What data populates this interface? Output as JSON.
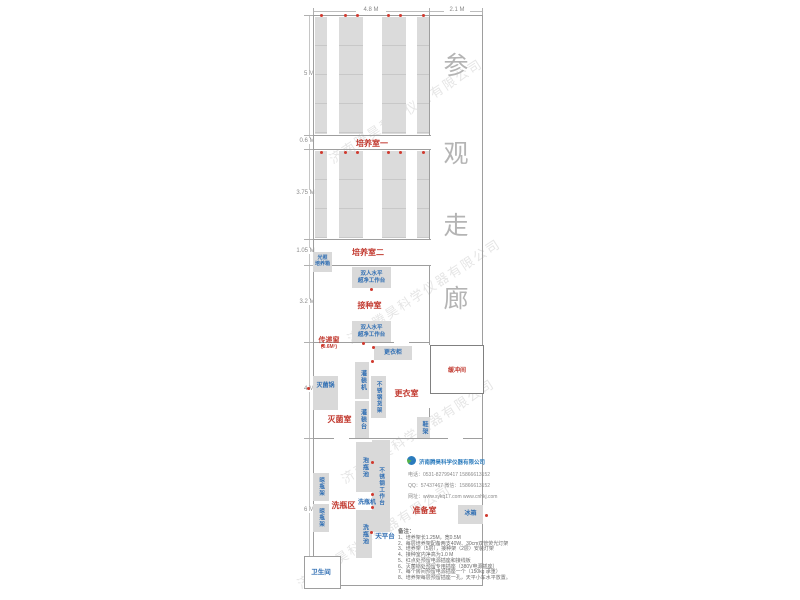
{
  "plan": {
    "corridor_chars": [
      "参",
      "观",
      "走",
      "廊"
    ],
    "dimensions": {
      "top_main": "4.8 M",
      "top_corridor": "2.1 M",
      "left": [
        "5 M",
        "0.6 M",
        "3.75 M",
        "1.05 M",
        "3.2 M",
        "4 M",
        "6 M"
      ]
    },
    "rooms": {
      "culture1": "培养室一",
      "culture2": "培养室二",
      "inoculation": "接种室",
      "sterilization": "灭菌室",
      "changing": "更衣室",
      "buffer": "缓冲间",
      "washing_area": "洗瓶区",
      "preparation": "准备室",
      "bathroom": "卫生间",
      "pass_window": "传递窗",
      "pass_window_size": "(0.6M²)"
    },
    "equipment": {
      "light_incubator": "光照\n培养箱",
      "clean_bench": "双人水平\n超净工作台",
      "wardrobe": "更衣柜",
      "filling_machine": "灌装机",
      "filling_table": "灌装台",
      "steel_shelf": "不锈钢货架",
      "autoclave": "灭菌锅",
      "shoe_rack": "鞋架",
      "soak_pool": "泡瓶池",
      "steel_worktable": "不锈钢工作台",
      "bottle_washer": "洗瓶机",
      "wash_pool": "洗瓶池",
      "balance_table": "天平台",
      "drying_rack": "晾瓶架",
      "fridge": "冰箱"
    },
    "outlets": [
      [
        321,
        15
      ],
      [
        345,
        15
      ],
      [
        357,
        15
      ],
      [
        388,
        15
      ],
      [
        400,
        15
      ],
      [
        423,
        15
      ],
      [
        321,
        152
      ],
      [
        345,
        152
      ],
      [
        357,
        152
      ],
      [
        388,
        152
      ],
      [
        400,
        152
      ],
      [
        423,
        152
      ],
      [
        371,
        289
      ],
      [
        363,
        343
      ],
      [
        322,
        345
      ],
      [
        373,
        347
      ],
      [
        308,
        388
      ],
      [
        372,
        361
      ],
      [
        372,
        462
      ],
      [
        372,
        494
      ],
      [
        372,
        507
      ],
      [
        371,
        532
      ],
      [
        486,
        515
      ]
    ]
  },
  "company": {
    "name": "济南腾昊科学仪器有限公司",
    "watermark": "济南腾昊科学仪器有限公司",
    "contacts": [
      "电话：0531-82799417  15866613152",
      "QQ：57437467  微信：15866613152",
      "网址：www.sykq17.com  www.cnhkj.com"
    ]
  },
  "notes": {
    "title": "备注：",
    "items": [
      "1、培养架长1.25M，宽0.5M",
      "2、每层培养架配备两支40W、30cm双管荧光灯架",
      "3、培养架（5层），接种架（2层）安装灯架",
      "4、接种室内净高为1.0 M",
      "5、红点处预留电源插座和接线板",
      "6、灭菌锅处预留专用插座（380V电源插座）",
      "7、每个房间预留电源插座一个（150kg 承重）",
      "8、培养架每层预留插座一孔，天平小车水平放置。"
    ]
  }
}
